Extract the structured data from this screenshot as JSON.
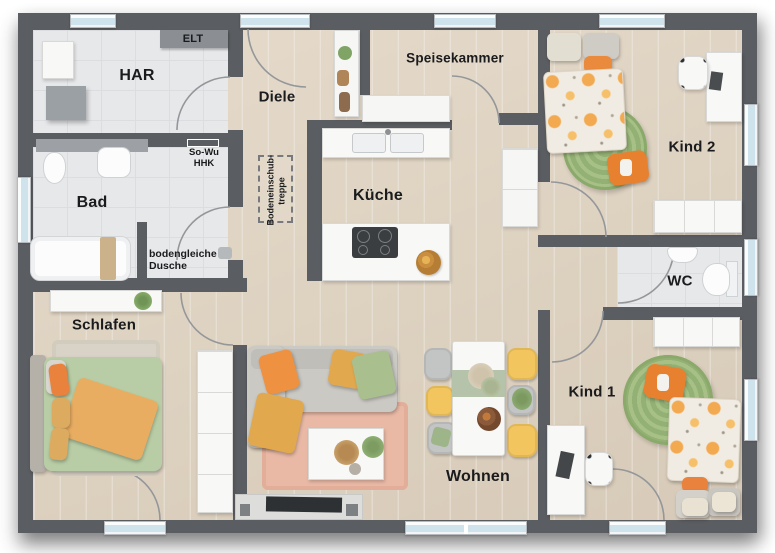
{
  "plan": {
    "title": "Grundriss Bungalow",
    "rooms": {
      "har": {
        "label": "HAR"
      },
      "elt": {
        "label": "ELT"
      },
      "diele": {
        "label": "Diele"
      },
      "speisekammer": {
        "label": "Speisekammer"
      },
      "kind2": {
        "label": "Kind 2"
      },
      "bad": {
        "label": "Bad"
      },
      "kueche": {
        "label": "Küche"
      },
      "wc": {
        "label": "WC"
      },
      "schlafen": {
        "label": "Schlafen"
      },
      "kind1": {
        "label": "Kind 1"
      },
      "wohnen": {
        "label": "Wohnen"
      }
    },
    "annotations": {
      "sowu_line1": "So-Wu",
      "sowu_line2": "HHK",
      "dusche_line1": "bodengleiche",
      "dusche_line2": "Dusche",
      "treppe_line1": "Bodeneinschub-",
      "treppe_line2": "treppe"
    },
    "colors": {
      "wall": "#5a5d61",
      "wood_floor": "#e0d4c4",
      "tile_floor": "#e7e8ea",
      "window_glass": "#cfe3ed",
      "accent_orange": "#e8812f",
      "accent_mustard": "#e2a84e",
      "accent_green": "#a3bd85",
      "chair_yellow": "#f2c55e",
      "duvet_green": "#b8cda5",
      "rug_pink": "#e9b9a6"
    }
  }
}
